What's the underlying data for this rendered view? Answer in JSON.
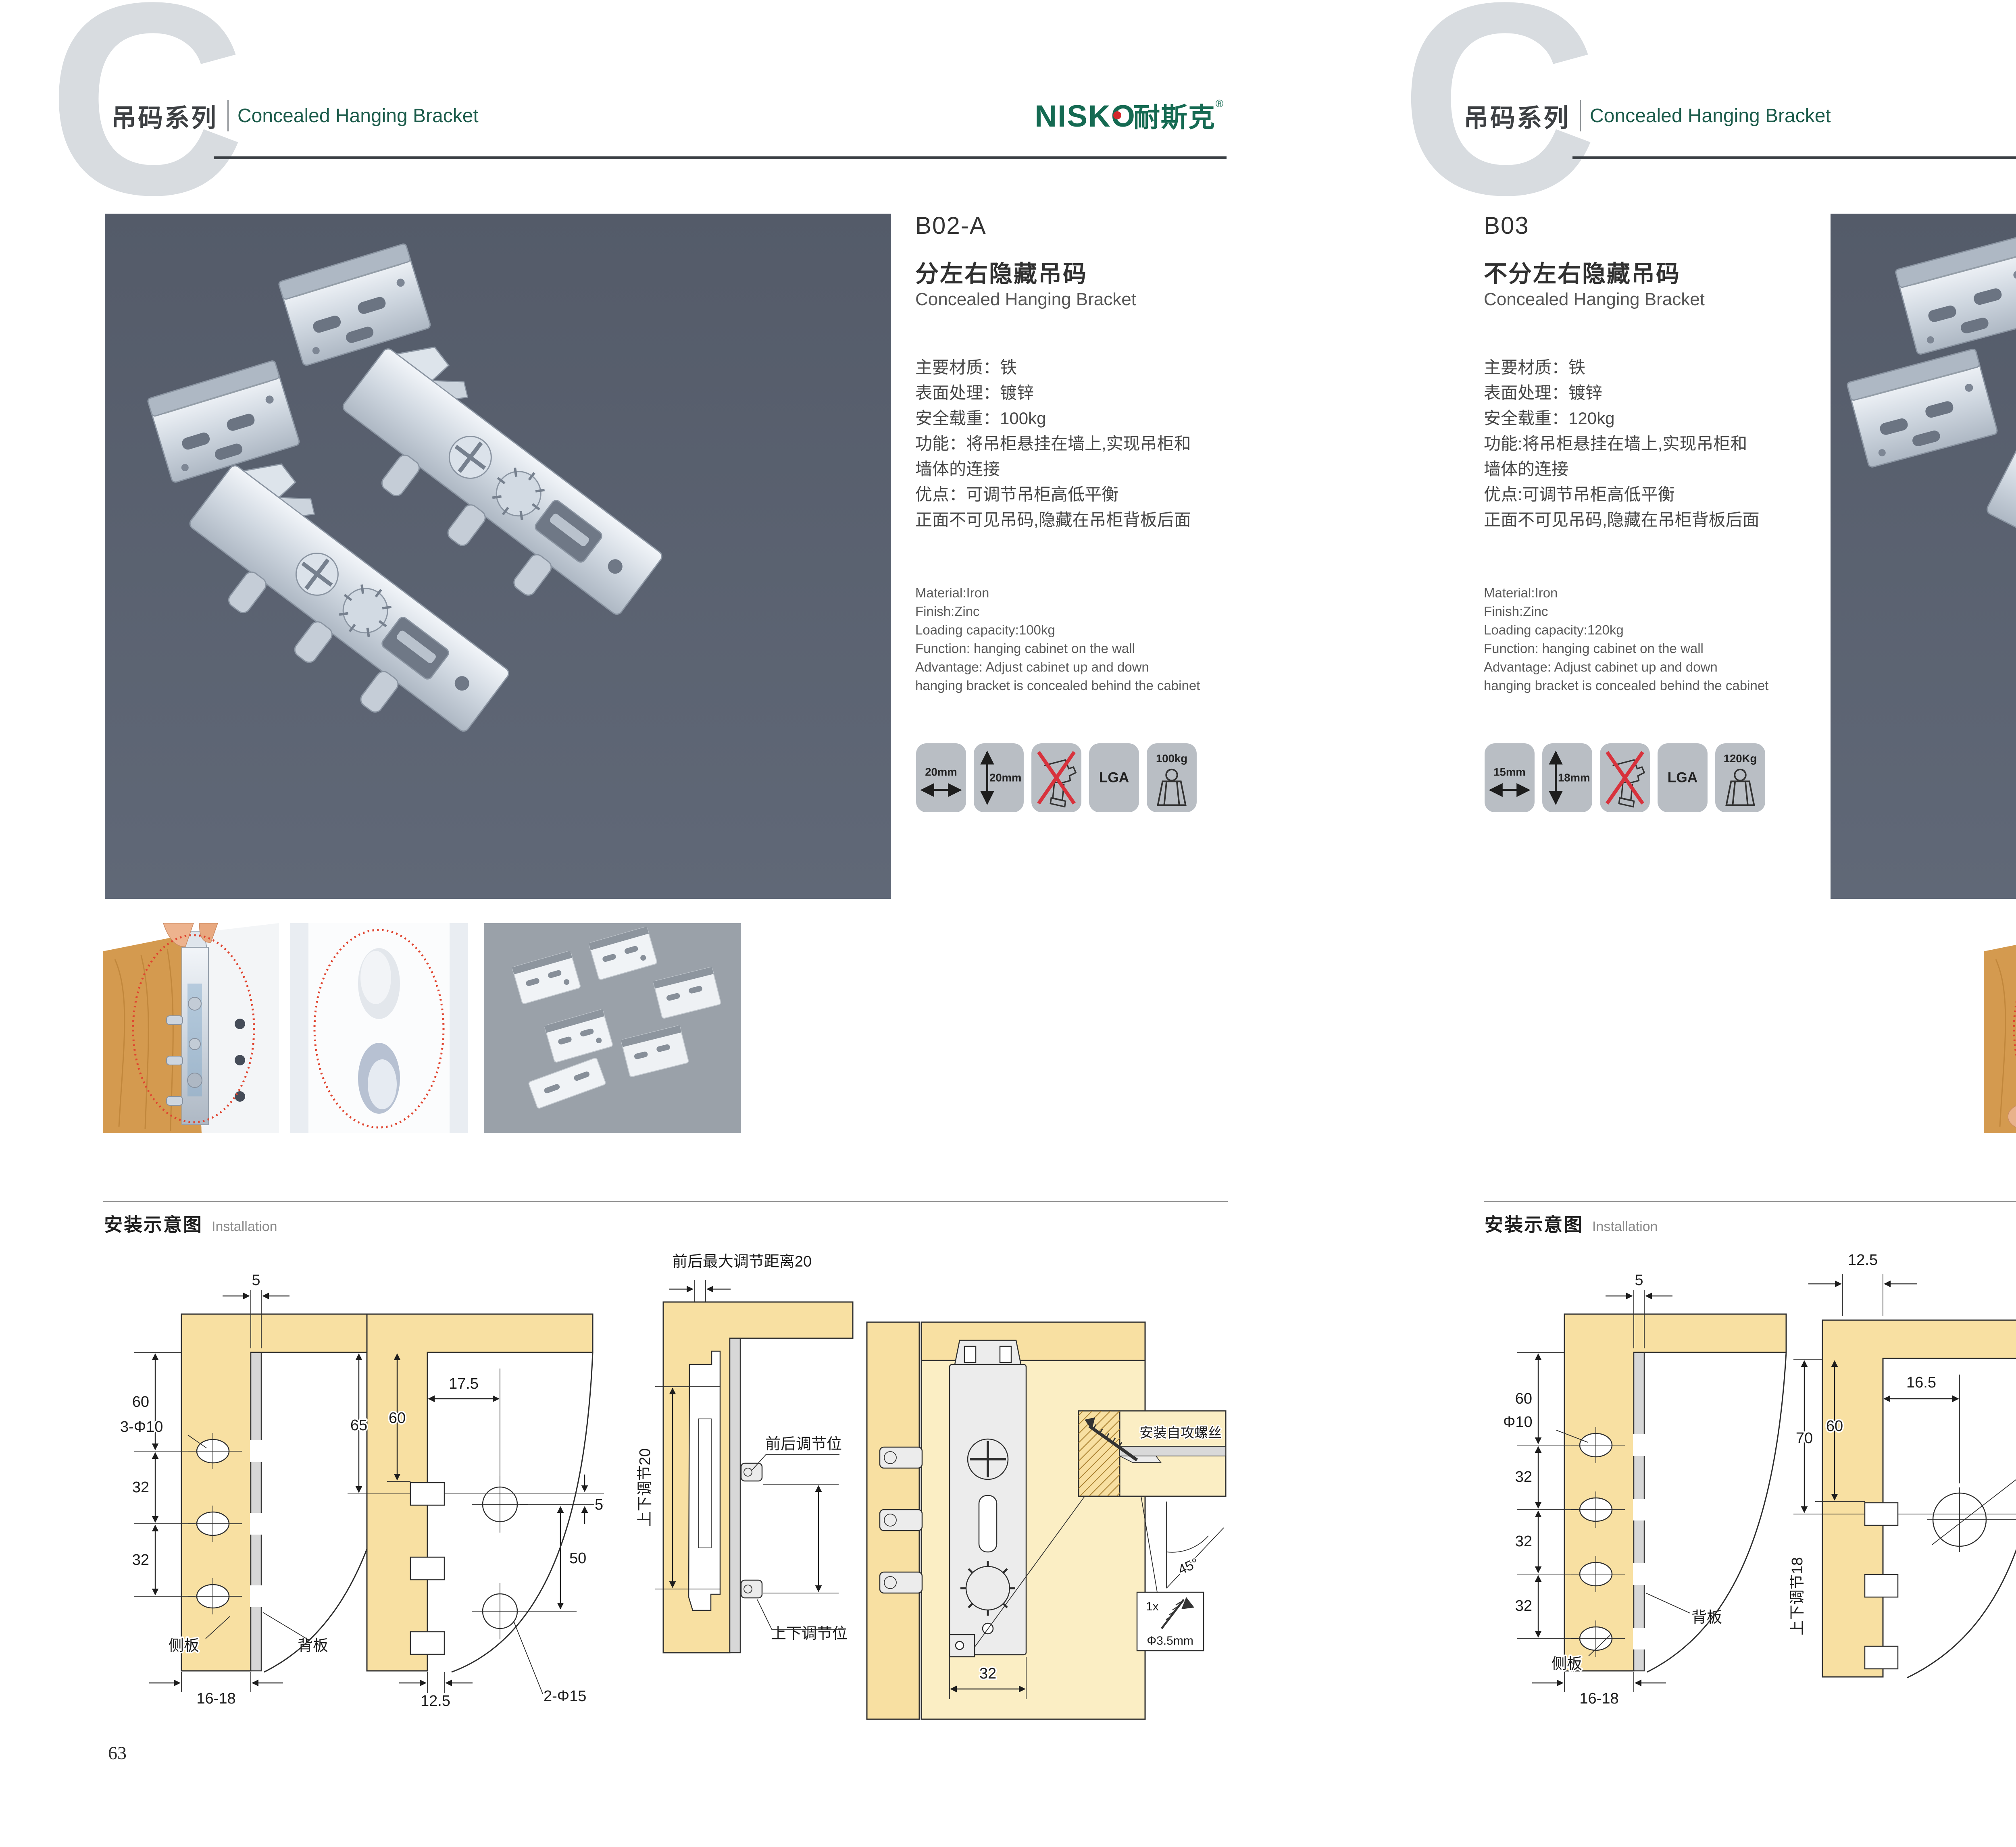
{
  "left": {
    "header": {
      "watermark": "C",
      "series_cn": "吊码系列",
      "series_en": "Concealed Hanging Bracket",
      "brand_en": "NISKO",
      "brand_cn": "耐斯克",
      "reg": "®"
    },
    "product": {
      "code": "B02-A",
      "title_cn": "分左右隐藏吊码",
      "title_en": "Concealed Hanging Bracket",
      "specs_cn": [
        "主要材质：铁",
        "表面处理：镀锌",
        "安全载重：100kg",
        "功能：将吊柜悬挂在墙上,实现吊柜和",
        "墙体的连接",
        "优点：可调节吊柜高低平衡",
        "正面不可见吊码,隐藏在吊柜背板后面"
      ],
      "specs_en": [
        "Material:Iron",
        "Finish:Zinc",
        "Loading capacity:100kg",
        "Function: hanging cabinet on the wall",
        "Advantage: Adjust cabinet up and down",
        "hanging bracket is concealed behind the cabinet"
      ],
      "badges": {
        "b1": "20mm",
        "b2": "20mm",
        "b4": "LGA",
        "b5": "100kg"
      }
    },
    "install_title_cn": "安装示意图",
    "install_title_en": "Installation",
    "d1": {
      "t5": "5",
      "t60": "60",
      "holes": "3-Φ10",
      "t32a": "32",
      "t32b": "32",
      "side": "侧板",
      "back": "背板",
      "tb": "16-18"
    },
    "d2": {
      "t65": "65",
      "t60": "60",
      "t175": "17.5",
      "t5": "5",
      "t50": "50",
      "holes": "2-Φ15",
      "tb": "12.5"
    },
    "d3": {
      "top": "前后最大调节距离20",
      "side": "上下调节20",
      "l1": "前后调节位",
      "l2": "上下调节位"
    },
    "d4": {
      "t32": "32",
      "screw": "安装自攻螺丝",
      "angle": "45°",
      "qty": "1x",
      "dia": "Φ3.5mm"
    },
    "page_no": "63"
  },
  "right": {
    "header": {
      "watermark": "C",
      "series_cn": "吊码系列",
      "series_en": "Concealed Hanging Bracket",
      "brand_en": "NISKO",
      "brand_cn": "耐斯克",
      "reg": "®"
    },
    "product": {
      "code": "B03",
      "title_cn": "不分左右隐藏吊码",
      "title_en": "Concealed Hanging Bracket",
      "specs_cn": [
        "主要材质：铁",
        "表面处理：镀锌",
        "安全载重：120kg",
        "功能:将吊柜悬挂在墙上,实现吊柜和",
        "墙体的连接",
        "优点:可调节吊柜高低平衡",
        "正面不可见吊码,隐藏在吊柜背板后面"
      ],
      "specs_en": [
        "Material:Iron",
        "Finish:Zinc",
        "Loading capacity:120kg",
        "Function: hanging cabinet on the wall",
        "Advantage: Adjust cabinet up and down",
        "hanging bracket is concealed behind the cabinet"
      ],
      "badges": {
        "b1": "15mm",
        "b2": "18mm",
        "b4": "LGA",
        "b5": "120Kg"
      }
    },
    "install_title_cn": "安装示意图",
    "install_title_en": "Installation",
    "d1": {
      "t5": "5",
      "t60": "60",
      "holes": "Φ10",
      "t32a": "32",
      "t32b": "32",
      "t32c": "32",
      "side": "侧板",
      "back": "背板",
      "tb": "16-18"
    },
    "d2": {
      "t125": "12.5",
      "t70": "70",
      "t60": "60",
      "t165": "16.5",
      "hole": "Ø 25",
      "t10": "10",
      "side": "上下调节18"
    },
    "d3": {
      "t165": "16.5",
      "t125": "12.5",
      "t10": "10",
      "hole": "Ø25",
      "lock": "锁紧状态",
      "screw": "安装自攻螺丝",
      "angle": "45°",
      "qty": "1x",
      "dia": "Φ3.5mm"
    },
    "page_no": "64"
  }
}
